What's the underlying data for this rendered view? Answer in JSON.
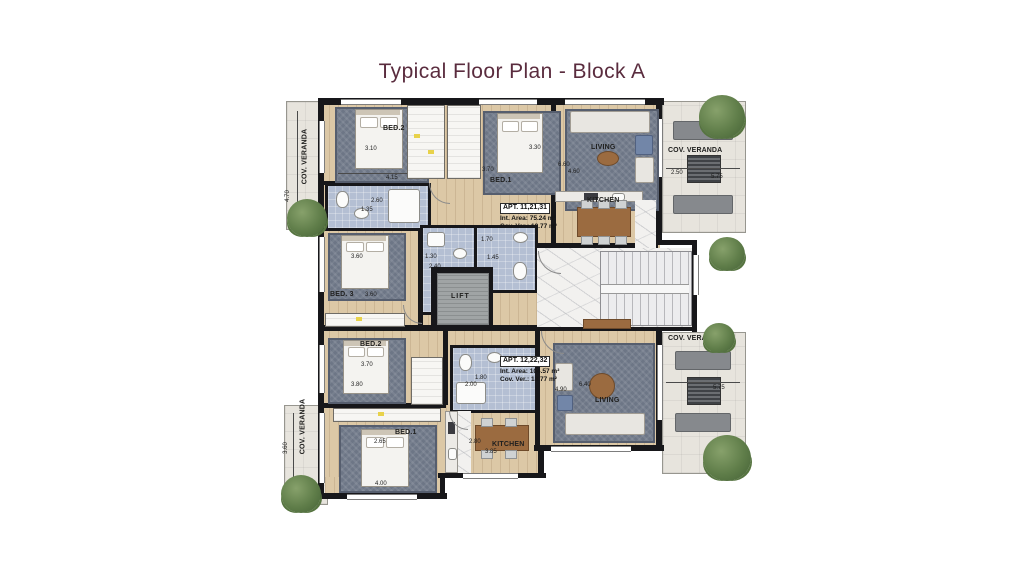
{
  "title": "Typical Floor Plan - Block A",
  "rooms": {
    "a1_bed2": "BED.2",
    "a1_bed1": "BED.1",
    "a1_living": "LIVING",
    "a1_kitchen": "KITCHEN",
    "bed3": "BED. 3",
    "lift": "LIFT",
    "a2_bed2": "BED.2",
    "a2_bed1": "BED.1",
    "a2_living": "LIVING",
    "a2_kitchen": "KITCHEN",
    "veranda": "COV. VERANDA"
  },
  "apartments": [
    {
      "name": "APT. 11,21,31",
      "int_area": "Int. Area: 75.24 m²",
      "cov_ver": "Cov. Ver.: 19.77 m²"
    },
    {
      "name": "APT. 12,22,32",
      "int_area": "Int. Area: 104.57 m²",
      "cov_ver": "Cov. Ver.: 18.77 m²"
    }
  ],
  "dims": {
    "d470": "4.70",
    "d120": "1.20",
    "d310": "3.10",
    "d415": "4.15",
    "d330": "3.30",
    "d370a": "3.70",
    "d260": "2.60",
    "d135": "1.35",
    "d660": "6.60",
    "d460": "4.60",
    "d250": "2.50",
    "d575a": "5.75",
    "d360a": "3.60",
    "d360b": "3.60",
    "d130": "1.30",
    "d240": "2.40",
    "d170": "1.70",
    "d145": "1.45",
    "d370b": "3.70",
    "d380": "3.80",
    "d180": "1.80",
    "d200": "2.00",
    "d265": "2.65",
    "d400": "4.00",
    "d280": "2.80",
    "d385": "3.85",
    "d490": "4.90",
    "d640": "6.40",
    "d575b": "5.75",
    "d360c": "3.60"
  },
  "colors": {
    "title": "#5a2c3e",
    "wall": "#17171a",
    "wood": "#dcc8a6",
    "rug": "#6d7686",
    "bath": "#b4bfd3",
    "veranda": "#e7e4dd",
    "marble": "#f2f1ef",
    "plant": "#5f7d49"
  }
}
